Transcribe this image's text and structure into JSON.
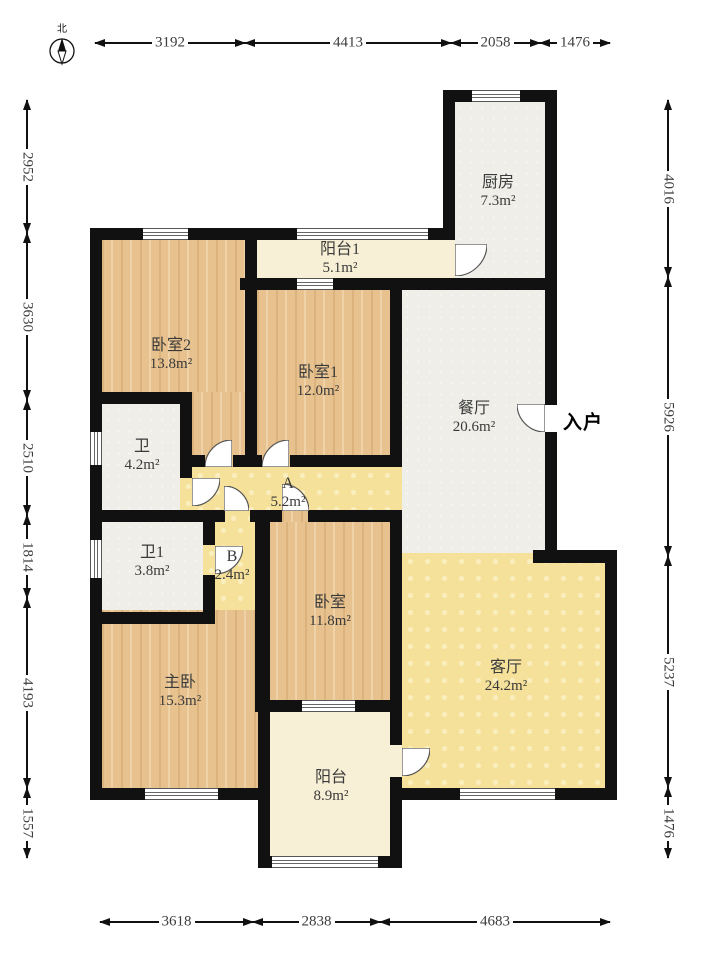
{
  "compass": {
    "north_label": "北"
  },
  "dims": {
    "top": [
      "3192",
      "4413",
      "2058",
      "1476"
    ],
    "bottom": [
      "3618",
      "2838",
      "4683"
    ],
    "left": [
      "2952",
      "3630",
      "2510",
      "1814",
      "4193",
      "1557"
    ],
    "right": [
      "4016",
      "5926",
      "5237",
      "1476"
    ]
  },
  "entry": {
    "label": "入户"
  },
  "rooms": {
    "kitchen": {
      "name": "厨房",
      "area": "7.3m²"
    },
    "balcony1": {
      "name": "阳台1",
      "area": "5.1m²"
    },
    "bedroom2": {
      "name": "卧室2",
      "area": "13.8m²"
    },
    "bedroom1": {
      "name": "卧室1",
      "area": "12.0m²"
    },
    "dining": {
      "name": "餐厅",
      "area": "20.6m²"
    },
    "bath": {
      "name": "卫",
      "area": "4.2m²"
    },
    "hall_a": {
      "name": "A",
      "area": "5.2m²"
    },
    "bath1": {
      "name": "卫1",
      "area": "3.8m²"
    },
    "corridor_b": {
      "name": "B",
      "area": "2.4m²"
    },
    "bedroom": {
      "name": "卧室",
      "area": "11.8m²"
    },
    "master": {
      "name": "主卧",
      "area": "15.3m²"
    },
    "living": {
      "name": "客厅",
      "area": "24.2m²"
    },
    "balcony": {
      "name": "阳台",
      "area": "8.9m²"
    }
  },
  "colors": {
    "wall": "#111111",
    "wood": "#e8c28e",
    "yellow": "#f5e19a",
    "cream": "#f7f0d6",
    "gray": "#efeee9"
  }
}
